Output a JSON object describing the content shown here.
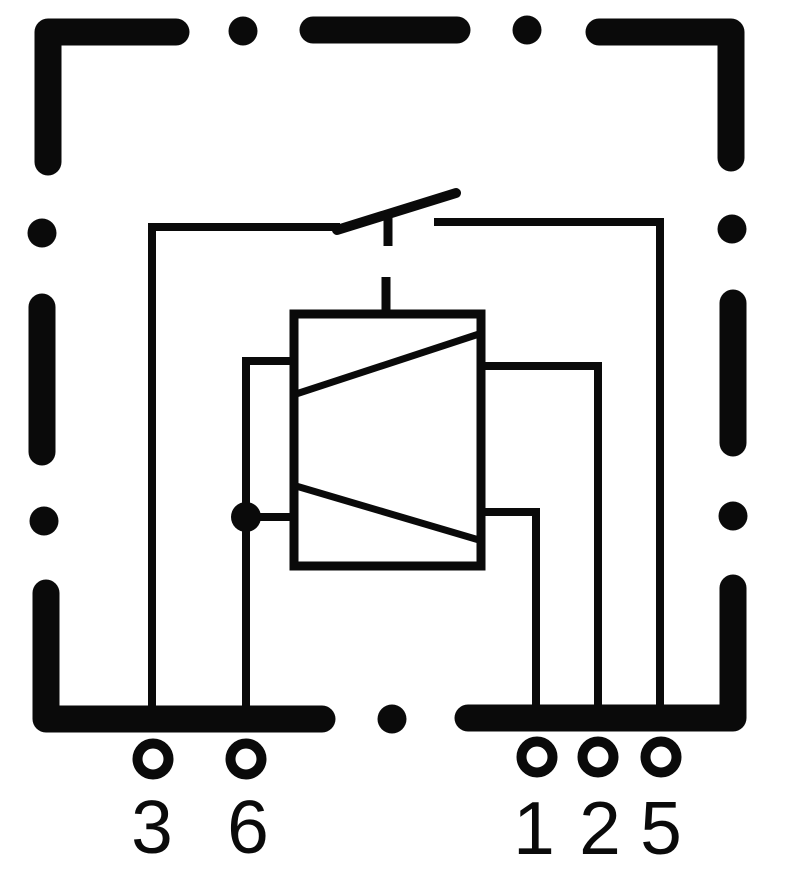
{
  "diagram": {
    "kind": "relay-circuit-schematic",
    "colors": {
      "line": "#0a0a0a",
      "background": "#ffffff"
    },
    "pins": [
      {
        "label": "3"
      },
      {
        "label": "6"
      },
      {
        "label": "1"
      },
      {
        "label": "2"
      },
      {
        "label": "5"
      }
    ]
  }
}
